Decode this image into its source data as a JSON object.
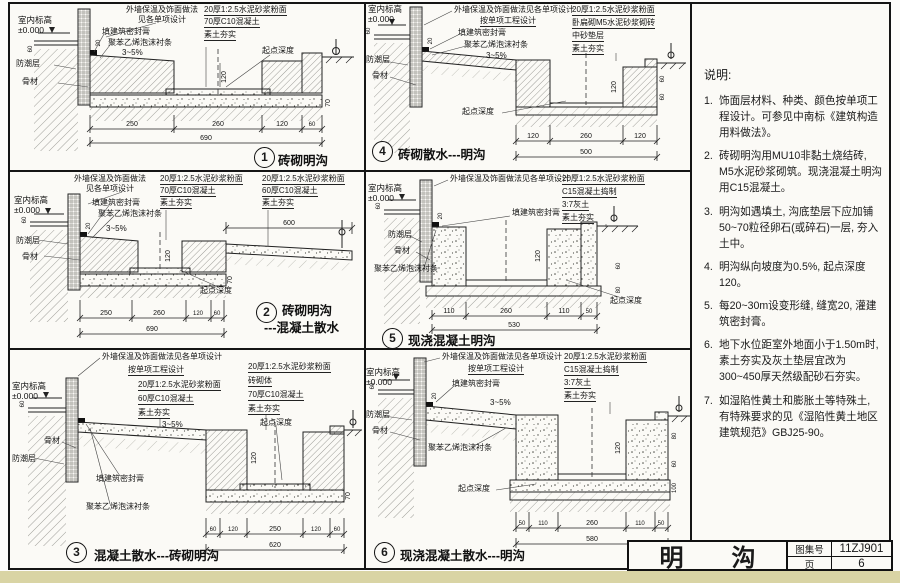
{
  "page": {
    "bg": "#fbfaf6",
    "line_color": "#151515",
    "bottom_strip_color": "#d9d4a4"
  },
  "common": {
    "indoor_level": "室内标高",
    "level": "±0.000",
    "wall_finish_1": "外墙保温及饰面做法",
    "wall_finish_2": "见各单项设计",
    "wall_finish_one": "外墙保温及饰面做法见各单项设计",
    "per_project": "按单项工程设计",
    "sealant": "填建筑密封膏",
    "foam": "聚苯乙烯泡沫衬条",
    "dpc": "防潮层",
    "aggregate": "骨材",
    "slope": "3~5%",
    "start_depth": "起点深度",
    "mortar": "20厚1:2.5水泥砂浆粉面",
    "c10_70": "70厚C10混凝土",
    "c10_60": "60厚C10混凝土",
    "c15": "C15混凝土捣制",
    "lime": "3:7灰土",
    "brick_m5": "卧扁砌M5水泥砂浆砌砖",
    "sand_bed": "中砂垫层",
    "brick_body": "砖砌体",
    "rammed": "素土夯实",
    "joint20": "20",
    "wall60": "60"
  },
  "details": {
    "d1": {
      "num": "1",
      "title": "砖砌明沟",
      "dims": [
        "250",
        "260",
        "120",
        "60"
      ],
      "total": "690",
      "vdims": [
        "120",
        "70"
      ]
    },
    "d2": {
      "num": "2",
      "title_1": "砖砌明沟",
      "title_2": "---混凝土散水",
      "dims": [
        "250",
        "260",
        "120",
        "60"
      ],
      "total": "690",
      "extra": "600",
      "vdims": [
        "120",
        "70"
      ]
    },
    "d3": {
      "num": "3",
      "title": "混凝土散水---砖砌明沟",
      "dims": [
        "60",
        "120",
        "250",
        "120",
        "60"
      ],
      "total": "620",
      "vdims": [
        "120",
        "70"
      ]
    },
    "d4": {
      "num": "4",
      "title": "砖砌散水---明沟",
      "dims": [
        "120",
        "260",
        "120"
      ],
      "total": "500",
      "vdims": [
        "120",
        "60",
        "60"
      ]
    },
    "d5": {
      "num": "5",
      "title": "现浇混凝土明沟",
      "dims": [
        "110",
        "260",
        "110",
        "50"
      ],
      "total": "530",
      "vdims": [
        "120",
        "60",
        "80"
      ]
    },
    "d6": {
      "num": "6",
      "title": "现浇混凝土散水---明沟",
      "dims": [
        "50",
        "110",
        "260",
        "110",
        "50"
      ],
      "total": "580",
      "vdims": [
        "120",
        "80",
        "60",
        "100"
      ]
    }
  },
  "notes": {
    "heading": "说明:",
    "items": [
      {
        "num": "1.",
        "text": "饰面层材料、种类、颜色按单项工程设计。可参见中南标《建筑构造用料做法》。"
      },
      {
        "num": "2.",
        "text": "砖砌明沟用MU10非黏土烧结砖, M5水泥砂浆砌筑。现浇混凝土明沟用C15混凝土。"
      },
      {
        "num": "3.",
        "text": "明沟如遇填土, 沟底垫层下应加铺50~70粒径卵石(或碎石)一层, 夯入土中。"
      },
      {
        "num": "4.",
        "text": "明沟纵向坡度为0.5%, 起点深度120。"
      },
      {
        "num": "5.",
        "text": "每20~30m设变形缝, 缝宽20, 灌建筑密封膏。"
      },
      {
        "num": "6.",
        "text": "地下水位距室外地面小于1.50m时, 素土夯实及灰土垫层宜改为300~450厚天然级配砂石夯实。"
      },
      {
        "num": "7.",
        "text": "如湿陷性黄土和膨胀土等特殊土, 有特殊要求的见《湿陷性黄土地区建筑规范》GBJ25-90。"
      }
    ]
  },
  "titleblock": {
    "name": "明　　沟",
    "atlas_label": "图集号",
    "atlas_no": "11ZJ901",
    "page_label": "页",
    "page_no": "6"
  }
}
